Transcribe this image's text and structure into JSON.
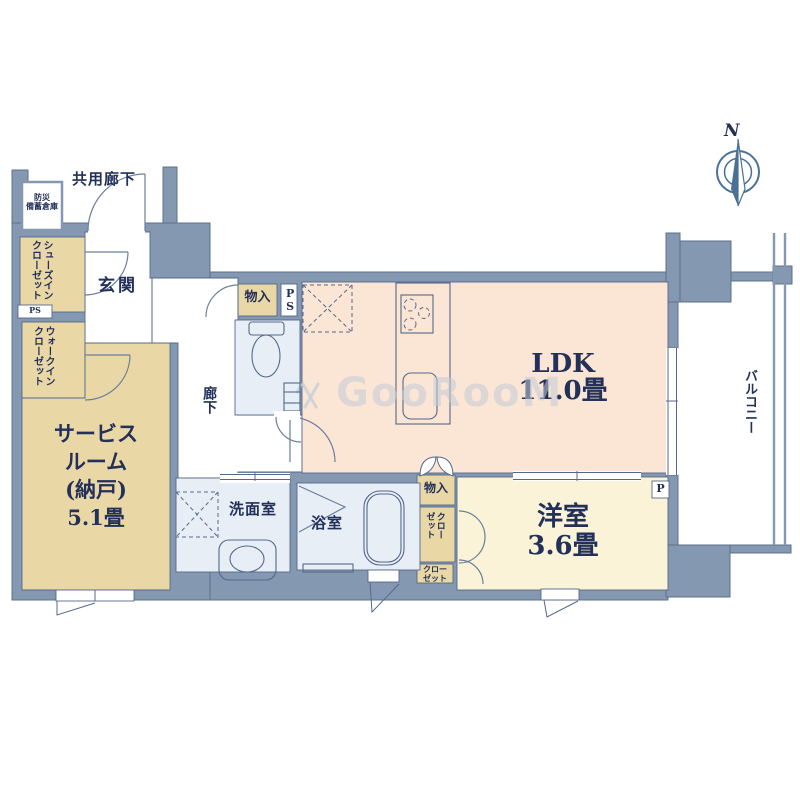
{
  "palette": {
    "wall_fill": "#8598b1",
    "wall_stroke": "#5d7189",
    "floor_ldk": "#fbe5d4",
    "floor_western": "#faf3d7",
    "floor_tan": "#e9d8a5",
    "floor_wet": "#e7eef5",
    "text_navy": "#22305a",
    "line_navy": "#55688c",
    "door": "#6b7f9c",
    "compass_blue": "#4a7096",
    "watermark": "#c3cdd8"
  },
  "compass": {
    "label": "N"
  },
  "watermark": {
    "text": "GooRooM"
  },
  "labels": {
    "common_corridor": "共用廊下",
    "disaster_storage": [
      "防災",
      "備蓄倉庫"
    ],
    "shoes_in_closet": [
      "シューズイン",
      "クローゼット"
    ],
    "entrance": "玄関",
    "ps_left": "PS",
    "walk_in_closet": [
      "ウォークイン",
      "クローゼット"
    ],
    "service_room": [
      "サービス",
      "ルーム",
      "(納戸)",
      "5.1畳"
    ],
    "corridor": "廊下",
    "storage_top": "物入",
    "ps_shaft": "PS",
    "ldk": [
      "LDK",
      "11.0畳"
    ],
    "storage_bottom": "物入",
    "closet_upper": [
      "クロー",
      "ゼット"
    ],
    "closet_lower": [
      "クロー",
      "ゼット"
    ],
    "western_room": [
      "洋室",
      "3.6畳"
    ],
    "pipe_right": "P",
    "washroom": "洗面室",
    "bathroom": "浴室",
    "balcony": "バルコニー"
  }
}
